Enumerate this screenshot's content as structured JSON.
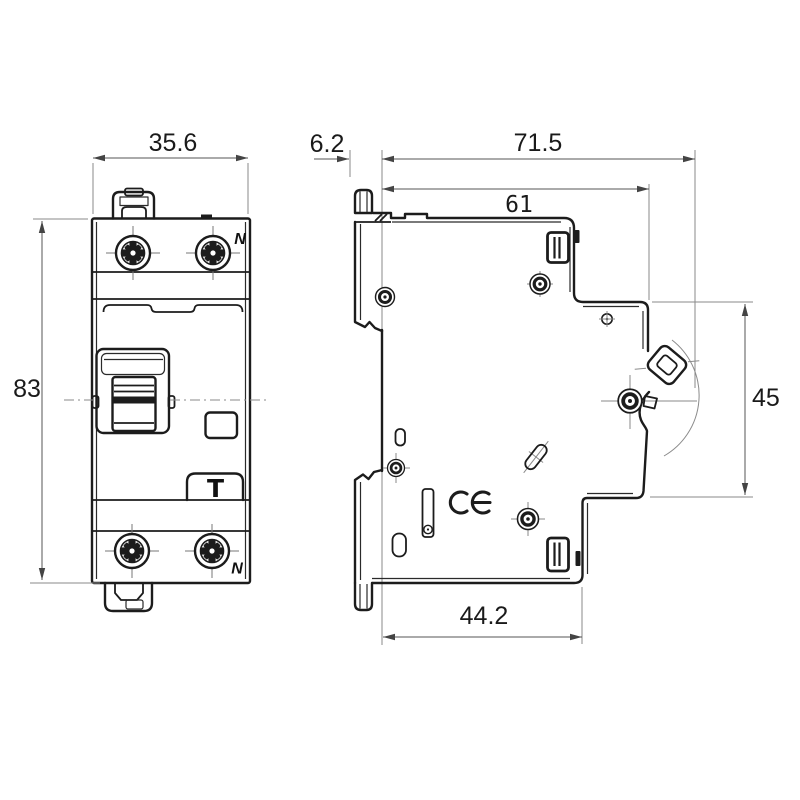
{
  "dims": {
    "front_width": "35.6",
    "front_height": "83",
    "rail_offset": "6.2",
    "total_depth": "71.5",
    "upper_depth": "61",
    "front_face_height": "45",
    "lower_depth": "44.2"
  },
  "labels": {
    "neutral_top": "N",
    "neutral_bottom": "N",
    "test_button": "T"
  },
  "icons": {
    "ce_mark_text": "CE",
    "terminal_screw": "pozidriv-screw",
    "rivet": "rivet-grommet",
    "toggle_switch": "toggle-handle",
    "din_clip": "din-rail-clip"
  },
  "colors": {
    "line": "#1c1c1c",
    "dimension_line": "#555555",
    "extension_line": "#8a8a8a",
    "text": "#1a1a1a",
    "background": "#ffffff"
  }
}
